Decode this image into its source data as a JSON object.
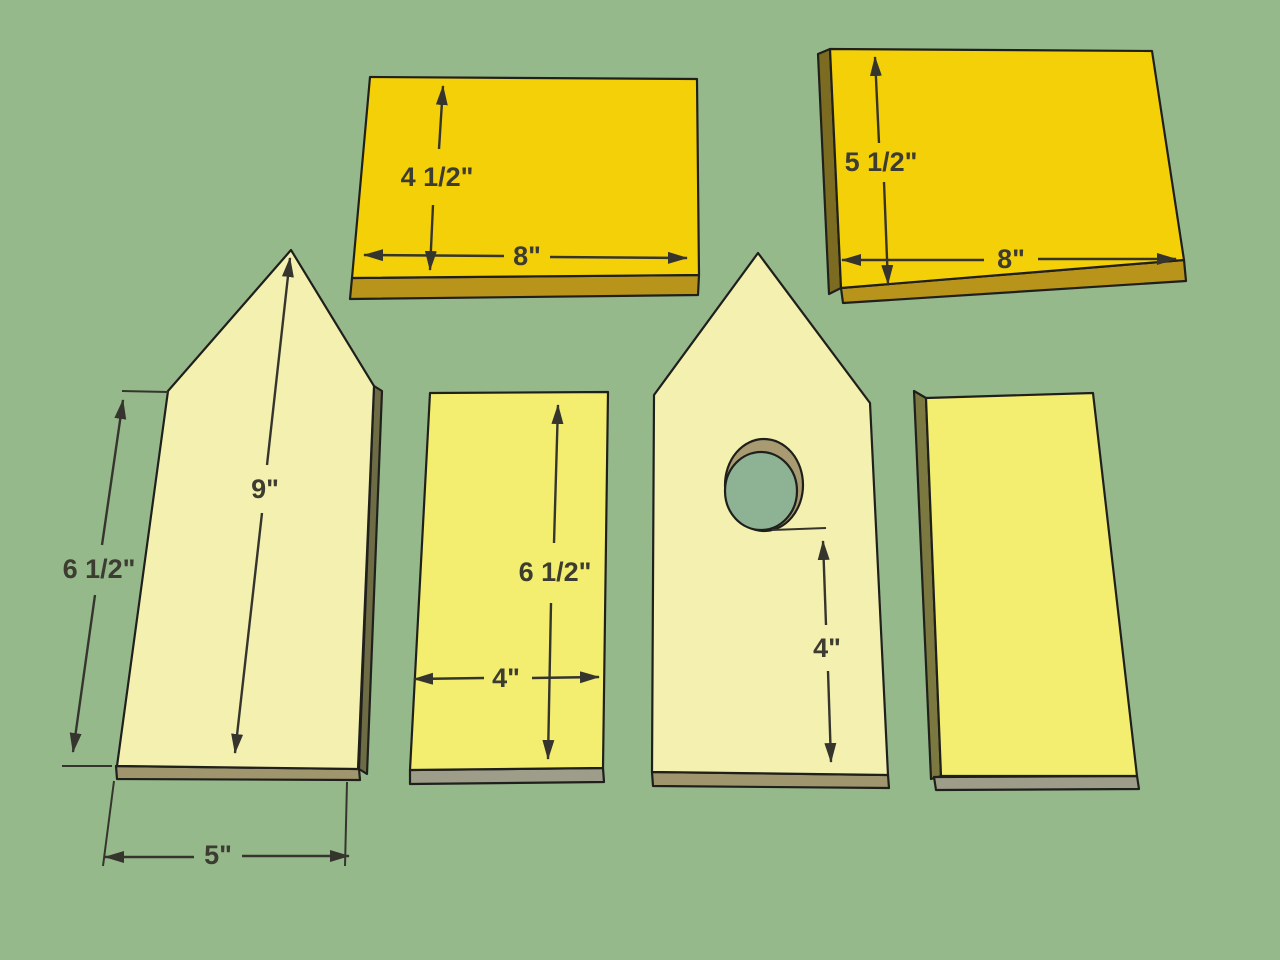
{
  "palette": {
    "bg": "#96b98c",
    "gold": "#f4d008",
    "gold-edge": "#b9941b",
    "gold-edge-dark": "#7c6c22",
    "cream": "#f4f1b0",
    "lemon": "#f3ee6f",
    "edge-tan": "#a0966d",
    "edge-gray": "#9d9d89",
    "edge-olive": "#6e6c45",
    "edge-olive-light": "#7b7940",
    "hole-rim": "#a89b72",
    "hole-green": "#8db394",
    "outline": "#1f1f1c",
    "dim": "#35352e",
    "label": "#3c3c31"
  },
  "labels": {
    "p1_height": "4 1/2\"",
    "p1_width": "8\"",
    "p2_height": "5 1/2\"",
    "p2_width": "8\"",
    "p3_ridge": "9\"",
    "p3_side": "6 1/2\"",
    "p3_width": "5\"",
    "p4_height": "6 1/2\"",
    "p4_width": "4\"",
    "p5_hole_offset": "4\""
  }
}
